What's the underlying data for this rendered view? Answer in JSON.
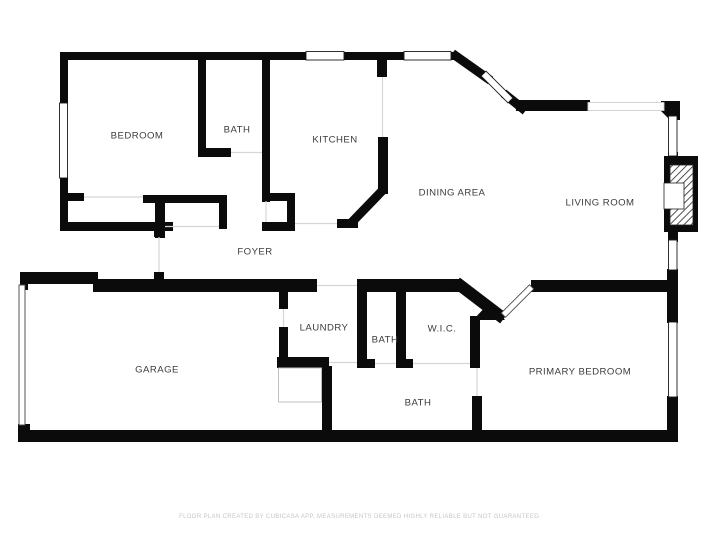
{
  "document": {
    "type": "floor-plan"
  },
  "colors": {
    "wall": "#0b0b0b",
    "label": "#3c3c3c",
    "footer": "#c6c6c6",
    "opening": "#d6d6d6"
  },
  "rooms": [
    {
      "label": "BEDROOM"
    },
    {
      "label": "BATH"
    },
    {
      "label": "KITCHEN"
    },
    {
      "label": "DINING AREA"
    },
    {
      "label": "LIVING ROOM"
    },
    {
      "label": "FOYER"
    },
    {
      "label": "LAUNDRY"
    },
    {
      "label": "BATH"
    },
    {
      "label": "W.I.C."
    },
    {
      "label": "GARAGE"
    },
    {
      "label": "BATH"
    },
    {
      "label": "PRIMARY BEDROOM"
    }
  ],
  "footer": {
    "disclaimer": "FLOOR PLAN CREATED BY CUBICASA APP. MEASUREMENTS DEEMED HIGHLY RELIABLE BUT NOT GUARANTEED."
  }
}
